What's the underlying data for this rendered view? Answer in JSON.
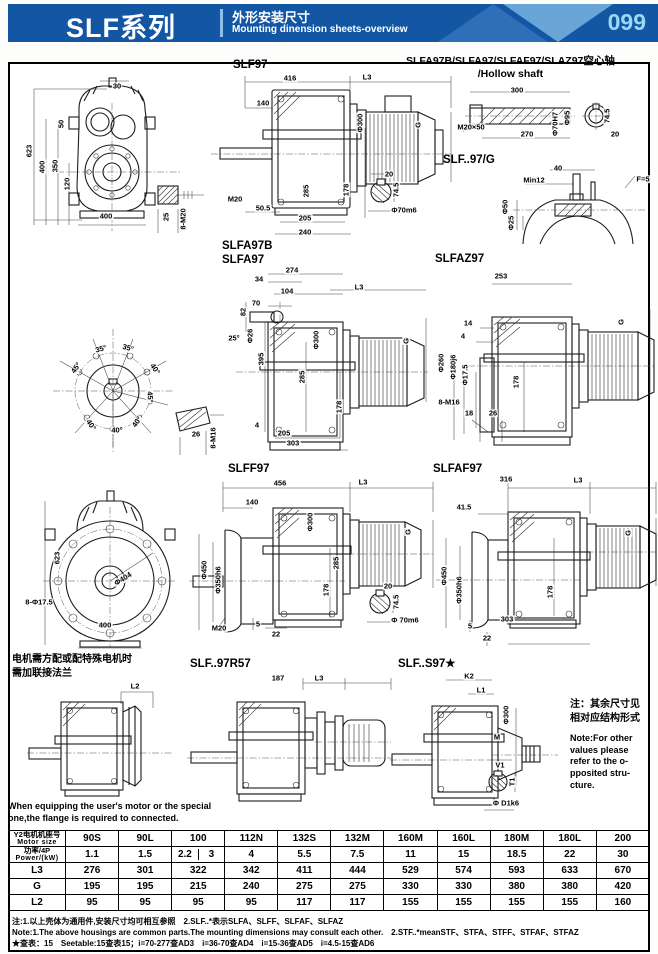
{
  "header": {
    "series": "SLF系列",
    "title_cn": "外形安装尺寸",
    "title_en": "Mounting dinension sheets-overview",
    "page": "099"
  },
  "colors": {
    "header_bg": "#1356a4",
    "accent_dark": "#2e6fb8",
    "accent_light": "#79b4e0",
    "page_number": "#9bd8f4"
  },
  "titles": {
    "slf97": "SLF97",
    "hollow_line1": "SLFA97B/SLFA97/SLFAF97/SLAZ97空心轴",
    "hollow_line2": "/Hollow shaft",
    "g97": "SLF..97/G",
    "slfa97b": "SLFA97B",
    "slfa97": "SLFA97",
    "slfaz97": "SLFAZ97",
    "slff97": "SLFF97",
    "slfaf97": "SLFAF97",
    "r57": "SLF..97R57",
    "s97": "SLF..S97★"
  },
  "notes": {
    "motor_cn": "电机需方配或配特殊电机时\n需加联接法兰",
    "motor_en": "When equipping the user's motor  or the special\none,the flange is required to connected.",
    "other_cn": "注：其余尺寸见\n相对应结构形式",
    "other_en": "Note:For other\nvalues please\nrefer to the o-\npposited stru-\ncture."
  },
  "drawings": {
    "slf97_front": {
      "labels": [
        {
          "t": "30",
          "x": 105,
          "y": 11
        },
        {
          "t": "50",
          "x": 49,
          "y": 49,
          "r": -90
        },
        {
          "t": "623",
          "x": 17,
          "y": 76,
          "r": -90
        },
        {
          "t": "400",
          "x": 30,
          "y": 92,
          "r": -90
        },
        {
          "t": "350",
          "x": 43,
          "y": 91,
          "r": -90
        },
        {
          "t": "120",
          "x": 55,
          "y": 109,
          "r": -90
        },
        {
          "t": "400",
          "x": 94,
          "y": 141
        }
      ]
    },
    "bolt_detail_m20": {
      "labels": [
        {
          "t": "25",
          "x": 14,
          "y": 34,
          "r": -90
        },
        {
          "t": "8-M20",
          "x": 31,
          "y": 36,
          "r": -90
        }
      ]
    },
    "slf97_side": {
      "labels": [
        {
          "t": "416",
          "x": 85,
          "y": 10
        },
        {
          "t": "L3",
          "x": 162,
          "y": 9
        },
        {
          "t": "140",
          "x": 58,
          "y": 35
        },
        {
          "t": "Φ300",
          "x": 155,
          "y": 55,
          "r": -90
        },
        {
          "t": "285",
          "x": 101,
          "y": 123,
          "r": -90
        },
        {
          "t": "G",
          "x": 213,
          "y": 57,
          "r": -90
        },
        {
          "t": "M20",
          "x": 30,
          "y": 131
        },
        {
          "t": "50.5",
          "x": 58,
          "y": 140
        },
        {
          "t": "178",
          "x": 141,
          "y": 122,
          "r": -90
        },
        {
          "t": "205",
          "x": 100,
          "y": 150
        },
        {
          "t": "240",
          "x": 100,
          "y": 164
        }
      ]
    },
    "shaft_detail_1": {
      "labels": [
        {
          "t": "20",
          "x": 29,
          "y": 9
        },
        {
          "t": "74.5",
          "x": 36,
          "y": 25,
          "r": -90
        },
        {
          "t": "Φ70m6",
          "x": 44,
          "y": 45
        }
      ]
    },
    "hollow_shaft": {
      "labels": [
        {
          "t": "300",
          "x": 62,
          "y": 8
        },
        {
          "t": "M20×50",
          "x": 16,
          "y": 45
        },
        {
          "t": "270",
          "x": 72,
          "y": 52
        },
        {
          "t": "Φ70H7",
          "x": 100,
          "y": 42,
          "r": -90
        },
        {
          "t": "Φ95",
          "x": 112,
          "y": 36,
          "r": -90
        },
        {
          "t": "74.5",
          "x": 152,
          "y": 34,
          "r": -90
        },
        {
          "t": "20",
          "x": 160,
          "y": 52
        }
      ]
    },
    "g97": {
      "labels": [
        {
          "t": "40",
          "x": 63,
          "y": 10
        },
        {
          "t": "Min12",
          "x": 39,
          "y": 22
        },
        {
          "t": "F=5",
          "x": 148,
          "y": 21
        },
        {
          "t": "Φ50",
          "x": 10,
          "y": 49,
          "r": -90
        },
        {
          "t": "Φ25",
          "x": 16,
          "y": 65,
          "r": -90
        }
      ]
    },
    "flange_angles": {
      "labels": [
        {
          "t": "35°",
          "x": 66,
          "y": 24,
          "r": -15
        },
        {
          "t": "35°",
          "x": 93,
          "y": 23,
          "r": 15
        },
        {
          "t": "45°",
          "x": 41,
          "y": 43,
          "r": -55
        },
        {
          "t": "40°",
          "x": 120,
          "y": 44,
          "r": 55
        },
        {
          "t": "45°",
          "x": 115,
          "y": 72,
          "r": 85
        },
        {
          "t": "40°",
          "x": 56,
          "y": 100,
          "r": 55
        },
        {
          "t": "40°",
          "x": 82,
          "y": 105
        },
        {
          "t": "40°",
          "x": 102,
          "y": 97,
          "r": -55
        }
      ]
    },
    "slfa97": {
      "labels": [
        {
          "t": "274",
          "x": 112,
          "y": 8
        },
        {
          "t": "34",
          "x": 79,
          "y": 17
        },
        {
          "t": "104",
          "x": 107,
          "y": 29
        },
        {
          "t": "70",
          "x": 76,
          "y": 41
        },
        {
          "t": "82",
          "x": 63,
          "y": 50,
          "r": -90
        },
        {
          "t": "25°",
          "x": 54,
          "y": 76
        },
        {
          "t": "Φ26",
          "x": 70,
          "y": 74,
          "r": -90
        },
        {
          "t": "395",
          "x": 81,
          "y": 97,
          "r": -90
        },
        {
          "t": "285",
          "x": 122,
          "y": 115,
          "r": -90
        },
        {
          "t": "Φ300",
          "x": 136,
          "y": 78,
          "r": -90
        },
        {
          "t": "L3",
          "x": 179,
          "y": 25
        },
        {
          "t": "G",
          "x": 226,
          "y": 79,
          "r": -90
        },
        {
          "t": "178",
          "x": 159,
          "y": 145,
          "r": -90
        },
        {
          "t": "4",
          "x": 77,
          "y": 163
        },
        {
          "t": "205",
          "x": 104,
          "y": 171
        },
        {
          "t": "303",
          "x": 113,
          "y": 181
        }
      ]
    },
    "m16_detail": {
      "labels": [
        {
          "t": "26",
          "x": 24,
          "y": 31
        },
        {
          "t": "8-M16",
          "x": 41,
          "y": 35,
          "r": -90
        }
      ]
    },
    "slfaz97": {
      "labels": [
        {
          "t": "253",
          "x": 69,
          "y": 14
        },
        {
          "t": "14",
          "x": 36,
          "y": 61
        },
        {
          "t": "4",
          "x": 31,
          "y": 74
        },
        {
          "t": "Φ260",
          "x": 9,
          "y": 101,
          "r": -90
        },
        {
          "t": "Φ180j6",
          "x": 21,
          "y": 105,
          "r": -90
        },
        {
          "t": "Φ17.5",
          "x": 33,
          "y": 113,
          "r": -90
        },
        {
          "t": "178",
          "x": 84,
          "y": 120,
          "r": -90
        },
        {
          "t": "8-M16",
          "x": 17,
          "y": 140
        },
        {
          "t": "18",
          "x": 37,
          "y": 151
        },
        {
          "t": "26",
          "x": 61,
          "y": 151
        },
        {
          "t": "G",
          "x": 189,
          "y": 60,
          "r": -90
        }
      ]
    },
    "flange_front": {
      "labels": [
        {
          "t": "623",
          "x": 42,
          "y": 73,
          "r": -90
        },
        {
          "t": "8-Φ17.5",
          "x": 24,
          "y": 117
        },
        {
          "t": "Φ404",
          "x": 108,
          "y": 94,
          "r": -32
        },
        {
          "t": "400",
          "x": 90,
          "y": 140
        }
      ]
    },
    "slff97": {
      "labels": [
        {
          "t": "456",
          "x": 95,
          "y": 15
        },
        {
          "t": "L3",
          "x": 178,
          "y": 14
        },
        {
          "t": "140",
          "x": 67,
          "y": 34
        },
        {
          "t": "Φ300",
          "x": 125,
          "y": 54,
          "r": -90
        },
        {
          "t": "Φ450",
          "x": 19,
          "y": 102,
          "r": -90
        },
        {
          "t": "Φ350h6",
          "x": 33,
          "y": 112,
          "r": -90
        },
        {
          "t": "285",
          "x": 151,
          "y": 95,
          "r": -90
        },
        {
          "t": "178",
          "x": 141,
          "y": 122,
          "r": -90
        },
        {
          "t": "M20",
          "x": 34,
          "y": 160
        },
        {
          "t": "5",
          "x": 73,
          "y": 156
        },
        {
          "t": "22",
          "x": 91,
          "y": 166
        },
        {
          "t": "G",
          "x": 223,
          "y": 64,
          "r": -90
        }
      ]
    },
    "shaft_detail_2": {
      "labels": [
        {
          "t": "20",
          "x": 28,
          "y": 11
        },
        {
          "t": "74.5",
          "x": 36,
          "y": 27,
          "r": -90
        },
        {
          "t": "Φ 70m6",
          "x": 45,
          "y": 45
        }
      ]
    },
    "slfaf97": {
      "labels": [
        {
          "t": "316",
          "x": 76,
          "y": 11
        },
        {
          "t": "L3",
          "x": 148,
          "y": 12
        },
        {
          "t": "41.5",
          "x": 34,
          "y": 39
        },
        {
          "t": "Φ450",
          "x": 14,
          "y": 108,
          "r": -90
        },
        {
          "t": "Φ350h6",
          "x": 29,
          "y": 122,
          "r": -90
        },
        {
          "t": "178",
          "x": 120,
          "y": 124,
          "r": -90
        },
        {
          "t": "303",
          "x": 77,
          "y": 151
        },
        {
          "t": "5",
          "x": 40,
          "y": 158
        },
        {
          "t": "22",
          "x": 57,
          "y": 170
        },
        {
          "t": "G",
          "x": 198,
          "y": 65,
          "r": -90
        }
      ]
    },
    "motor_note_drawing": {
      "labels": [
        {
          "t": "L2",
          "x": 110,
          "y": 6
        }
      ]
    },
    "r57": {
      "labels": [
        {
          "t": "187",
          "x": 93,
          "y": 8
        },
        {
          "t": "L3",
          "x": 134,
          "y": 8
        }
      ]
    },
    "s97": {
      "labels": [
        {
          "t": "K2",
          "x": 81,
          "y": 6
        },
        {
          "t": "L1",
          "x": 93,
          "y": 20
        },
        {
          "t": "Φ300",
          "x": 118,
          "y": 45,
          "r": -90
        },
        {
          "t": "M",
          "x": 109,
          "y": 67
        },
        {
          "t": "V1",
          "x": 112,
          "y": 95
        },
        {
          "t": "T1",
          "x": 124,
          "y": 112,
          "r": -90
        },
        {
          "t": "Φ D1k6",
          "x": 118,
          "y": 133
        }
      ]
    }
  },
  "table": {
    "rows": [
      {
        "label_cn": "Y2电机机座号",
        "label_en": "Motor size",
        "cells": [
          "90S",
          "90L",
          "100",
          "112N",
          "132S",
          "132M",
          "160M",
          "160L",
          "180M",
          "180L",
          "200"
        ]
      },
      {
        "label_cn": "功率/4P",
        "label_en": "Power/(kW)",
        "cells": [
          "1.1",
          "1.5",
          [
            "2.2",
            "3"
          ],
          "4",
          "5.5",
          "7.5",
          "11",
          "15",
          "18.5",
          "22",
          "30"
        ]
      },
      {
        "label": "L3",
        "cells": [
          "276",
          "301",
          "322",
          "342",
          "411",
          "444",
          "529",
          "574",
          "593",
          "633",
          "670"
        ]
      },
      {
        "label": "G",
        "cells": [
          "195",
          "195",
          "215",
          "240",
          "275",
          "275",
          "330",
          "330",
          "380",
          "380",
          "420"
        ]
      },
      {
        "label": "L2",
        "cells": [
          "95",
          "95",
          "95",
          "95",
          "117",
          "117",
          "155",
          "155",
          "155",
          "155",
          "160"
        ]
      }
    ]
  },
  "footnotes": {
    "line1": "注:1.以上壳体为通用件,安装尺寸均可相互参照　2.SLF..*表示SLFA、SLFF、SLFAF、SLFAZ",
    "line2": "Note:1.The above housings are common parts.The mounting dimensions may consult each other.　2.STF..*meanSTF、STFA、STFF、STFAF、STFAZ",
    "line3": "★查表：15　Seetable:15查表15；i=70-277查AD3　i=36-70查AD4　i=15-36查AD5　i=4.5-15查AD6"
  }
}
